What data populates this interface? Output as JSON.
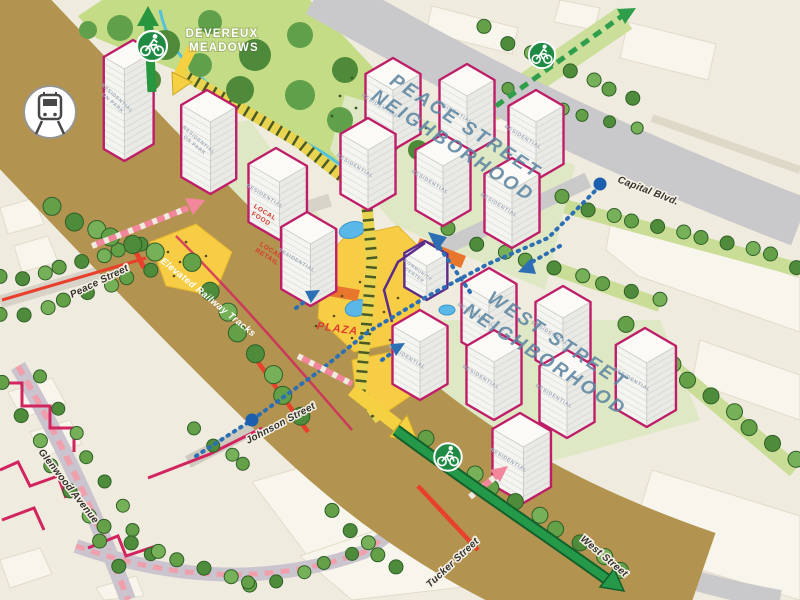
{
  "map": {
    "park": {
      "line1": "DEVEREUX",
      "line2": "MEADOWS"
    },
    "neighborhoods": {
      "peace": {
        "line1": "PEACE STREET",
        "line2": "NEIGHBORHOOD"
      },
      "west": {
        "line1": "WEST STREET",
        "line2": "NEIGHBORHOOD"
      }
    },
    "streets": {
      "capital_blvd": "Capital Blvd.",
      "peace_street": "Peace Street",
      "glenwood_avenue": "Glenwood Avenue",
      "johnson_street": "Johnson Street",
      "tucker_street": "Tucker Street",
      "west_street": "West Street",
      "elevated_railway": "Elevated Railway Tracks"
    },
    "places": {
      "plaza": "PLAZA",
      "local_food_line1": "LOCAL",
      "local_food_line2": "FOOD",
      "local_retail_line1": "LOCAL",
      "local_retail_line2": "RETAIL",
      "residential": "RESIDENTIAL",
      "residential_on_park_line1": "RESIDENTIAL",
      "residential_on_park_line2": "ON PARK",
      "community_center_line1": "COMMUNITY",
      "community_center_line2": "CENTER"
    },
    "icons": {
      "train": "train-icon",
      "bike": "bike-icon"
    },
    "colors": {
      "building_outline": "#BE1E68",
      "community_center_outline": "#5B2B8A",
      "bike_route_green": "#1F8A44",
      "transit_blue": "#1B5FAE",
      "pedestrian_pink": "#F2879B",
      "plaza_yellow": "#F6CD45",
      "park_green": "#C4DC86",
      "railway_tan": "#C8A76A",
      "neighborhood_label_blue": "#5E87A2",
      "street_red": "#E8402C",
      "property_line_crimson": "#D2245E"
    }
  }
}
